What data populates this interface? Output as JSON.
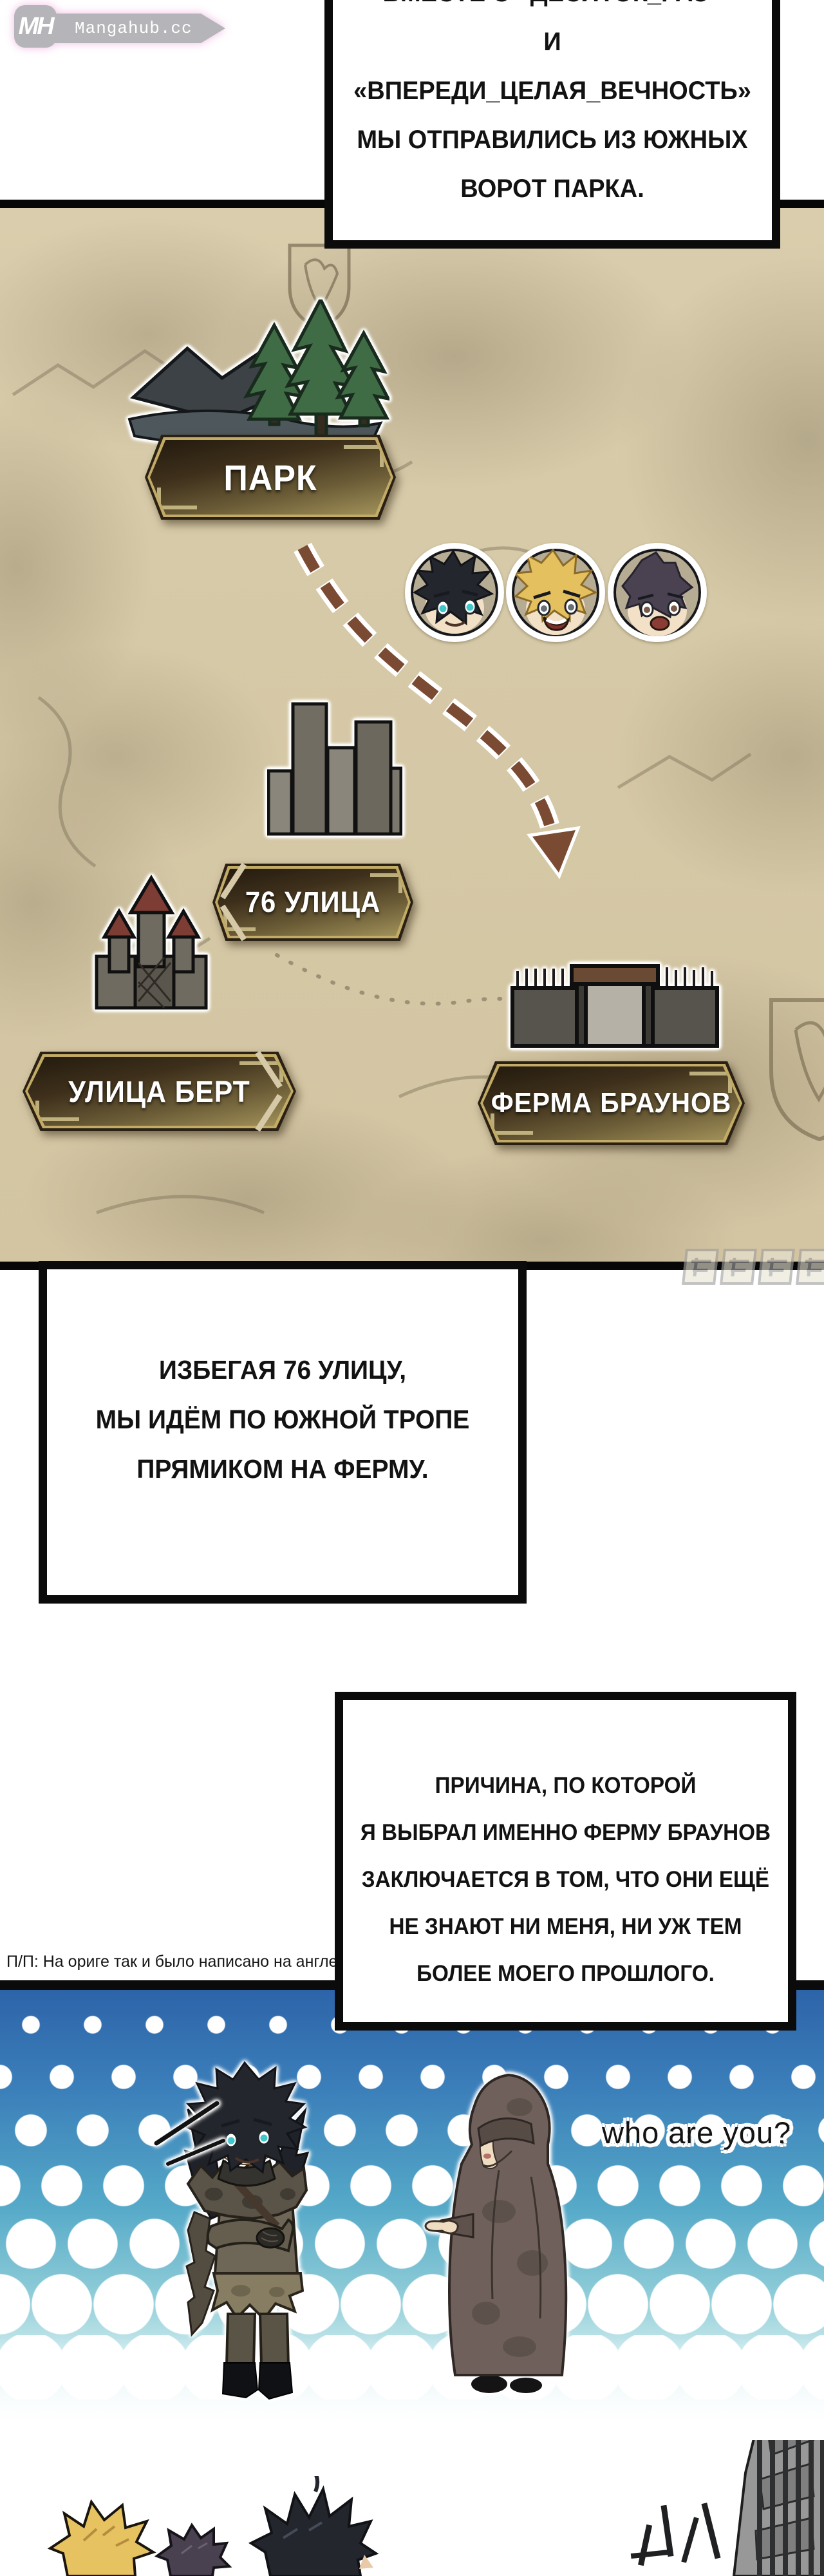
{
  "watermark_logo": {
    "initials": "MH",
    "site": "Mangahub.cc"
  },
  "narration_top": {
    "lines": [
      "ВМЕСТЕ С «ДЕСЯТОК_РАЗ»",
      "И «ВПЕРЕДИ_ЦЕЛАЯ_ВЕЧНОСТЬ»",
      "МЫ ОТПРАВИЛИСЬ ИЗ ЮЖНЫХ",
      "ВОРОТ ПАРКА."
    ]
  },
  "map": {
    "labels": {
      "park": "ПАРК",
      "street_76": "76 УЛИЦА",
      "bert_street": "УЛИЦА БЕРТ",
      "browns_farm": "ФЕРМА БРАУНОВ"
    },
    "icons": {
      "park": "pine-trees-and-mountain",
      "street_76": "city-buildings",
      "bert_street": "castle",
      "browns_farm": "farm-gate",
      "route": "dashed-arrow-path",
      "party": [
        "black-haired-boy-avatar",
        "blonde-boy-avatar",
        "purple-haired-boy-avatar"
      ]
    }
  },
  "narration_route": {
    "lines": [
      "ИЗБЕГАЯ 76 УЛИЦУ,",
      "МЫ ИДЁМ ПО ЮЖНОЙ ТРОПЕ",
      "ПРЯМИКОМ НА ФЕРМУ."
    ]
  },
  "narration_reason": {
    "lines": [
      "ПРИЧИНА, ПО КОТОРОЙ",
      "Я ВЫБРАЛ ИМЕННО ФЕРМУ БРАУНОВ",
      "ЗАКЛЮЧАЕТСЯ В ТОМ, ЧТО ОНИ ЕЩЁ",
      "НЕ ЗНАЮТ НИ МЕНЯ, НИ УЖ ТЕМ",
      "БОЛЕЕ МОЕГО ПРОШЛОГО."
    ]
  },
  "translator_note": "П/П: На ориге так и было написано на англе",
  "dialogue": {
    "who_are_you": "who are you?"
  },
  "colors": {
    "sign_gold": "#c2ab66",
    "sign_light": "#a3935b",
    "route_brown": "#7a4a33",
    "panel_blue": "#2d64a9",
    "map_parchment": "#d6c9a7"
  }
}
